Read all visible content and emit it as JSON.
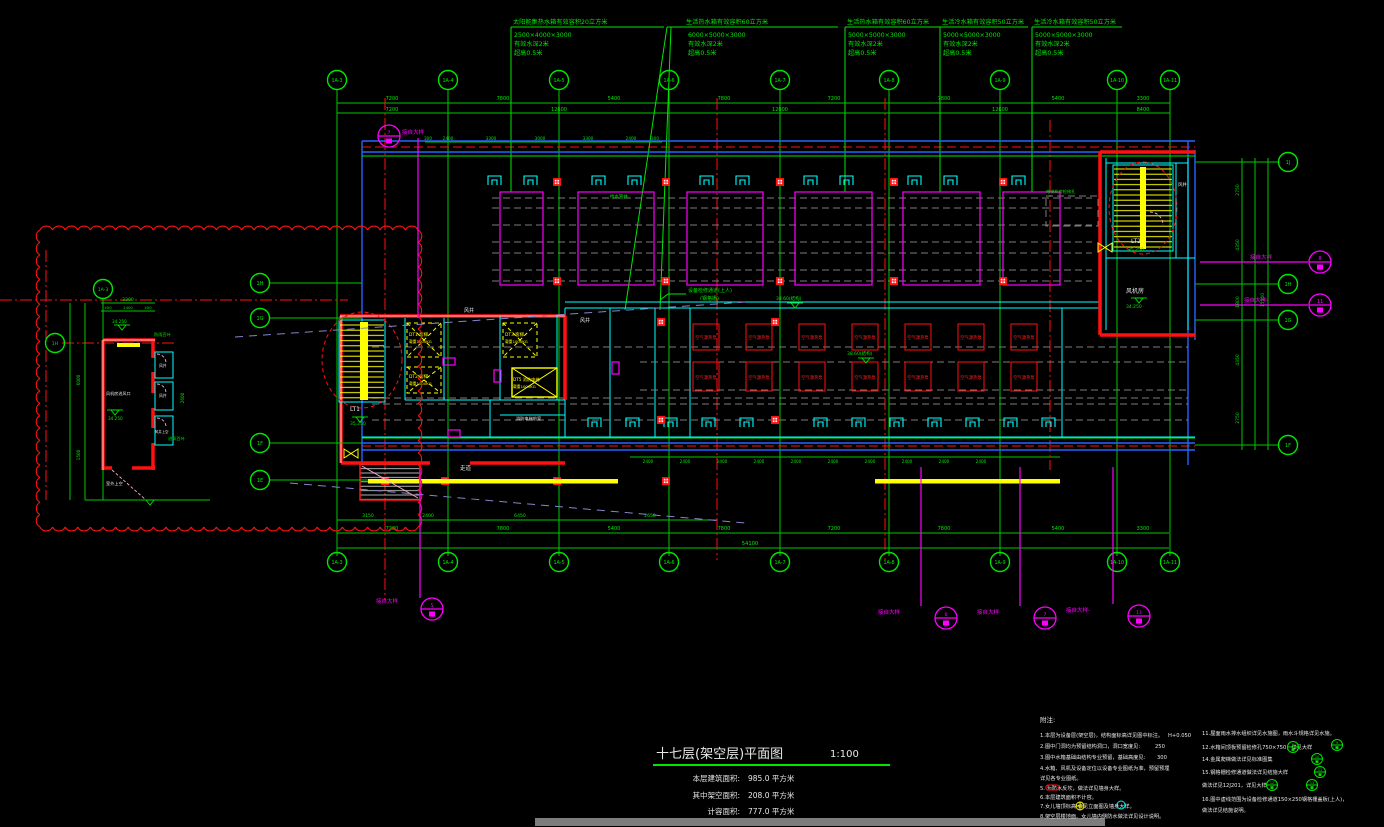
{
  "palette": {
    "bg": "#000000",
    "green": "#00e600",
    "red": "#ff1111",
    "magenta": "#ff00ff",
    "cyan": "#00ffff",
    "yellow": "#ffff00",
    "blue": "#2565ff",
    "gray": "#8c8c8c",
    "white": "#e8e8e8",
    "lavender": "#8484cf"
  },
  "tank_notes": [
    {
      "l1": "太阳能集热水箱有效容积20立方米",
      "l2": "2500×4000×3000",
      "l3": "有效水深2米",
      "l4": "超高0.5米"
    },
    {
      "l1": "生活热水箱有效容积60立方米",
      "l2": "6000×5000×3000",
      "l3": "有效水深2米",
      "l4": "超高0.5米"
    },
    {
      "l1": "生活热水箱有效容积60立方米",
      "l2": "5000×5000×3000",
      "l3": "有效水深2米",
      "l4": "超高0.5米"
    },
    {
      "l1": "生活冷水箱有效容积50立方米",
      "l2": "5000×5000×3000",
      "l3": "有效水深2米",
      "l4": "超高0.5米"
    },
    {
      "l1": "生活冷水箱有效容积50立方米",
      "l2": "5000×5000×3000",
      "l3": "有效水深2米",
      "l4": "超高0.5米"
    }
  ],
  "grid": {
    "top": [
      "1A-3",
      "1A-4",
      "1A-5",
      "1A-6",
      "1A-7",
      "1A-8",
      "1A-9",
      "1A-10",
      "1A-11"
    ],
    "bottom": [
      "1A-3",
      "1A-4",
      "1A-5",
      "1A-6",
      "1A-7",
      "1A-8",
      "1A-9",
      "1A-10",
      "1A-11"
    ],
    "right": [
      "1J",
      "1H",
      "1G",
      "1F"
    ],
    "left": [
      "1H",
      "1G",
      "1F",
      "1E"
    ],
    "detail_top": "1A-3",
    "detail_left": "1H"
  },
  "dims": {
    "top_row1": [
      "7200",
      "7800",
      "5400",
      "7800",
      "7200",
      "7800",
      "5400",
      "3300"
    ],
    "top_row2": [
      "7200",
      "12600",
      "12000",
      "12600",
      "8400"
    ],
    "top_fine": [
      "300",
      "2400",
      "3300",
      "3000",
      "3300",
      "2400",
      "300"
    ],
    "bottom_fine_label": "2400",
    "bottom_row1": [
      "3150",
      "2400",
      "6450",
      "2650"
    ],
    "bottom_row2": [
      "7200",
      "7800",
      "5400",
      "7800",
      "7200",
      "7800",
      "5400",
      "3300"
    ],
    "bottom_overall": "54100",
    "right_chain": [
      "2750",
      "4350",
      "1800",
      "4350",
      "2750"
    ],
    "right_overall": "15500",
    "detail_overall": "3300",
    "detail_subs": [
      "450",
      "2400",
      "450"
    ],
    "detail_left_chain": [
      "6000",
      "1500"
    ],
    "detail_right": "2600"
  },
  "plan": {
    "heat_pump_label": "空气源热泵",
    "corridor": "走道",
    "shaft": "风井",
    "shaft_void": "风井上空",
    "fan_room": "风机房",
    "stair1": "LT1",
    "stair2": "LT2",
    "elev": [
      {
        "id": "DT1 客梯",
        "load": "载重1000KG"
      },
      {
        "id": "DT2 客梯",
        "load": "载重1000KG"
      },
      {
        "id": "DT3 客梯",
        "load": "载重1000KG"
      },
      {
        "id": "DT5 消防电梯",
        "load": "载重1000KG"
      }
    ],
    "lobby": "消防电梯前室",
    "catwalk1": "设备检修通道(上人)",
    "catwalk2": "(钢格栅)",
    "lv_3860": "38.60(结构)",
    "lv_35250": "35.250",
    "lv_34250": "34.250",
    "water_shaft": "给水管井",
    "hatch_label": "电梯机房检修孔",
    "detail_room": "风机房进风口",
    "detail_outdoor": "室外上空",
    "detail_louver": "防雨百叶",
    "detail_louver2": "进风百叶"
  },
  "callouts": {
    "ref": "接自大样",
    "ref_dash": "接自大样-",
    "sheet": "图",
    "n_topleft": "7",
    "n_b1": "5",
    "n_b2": "6",
    "n_b3": "7",
    "n_b4": "11",
    "n_r1": "8",
    "n_r2": "11"
  },
  "title_block": {
    "title": "十七层(架空层)平面图",
    "scale": "1:100",
    "rows": [
      {
        "label": "本层建筑面积:",
        "value": "985.0 平方米"
      },
      {
        "label": "其中架空面积:",
        "value": "208.0 平方米"
      },
      {
        "label": "计容面积:",
        "value": "777.0 平方米"
      }
    ]
  },
  "notes": {
    "header": "附注:",
    "col1": [
      "1.本层为设备层(架空层)，结构面标高详见图中标注。",
      "2.图中门洞均为预留结构洞口，洞口宽度见:",
      "3.图中水箱基础由结构专业预留，基础高度见:",
      "4.水箱、风机及设备定位以设备专业图纸为准，预留预埋",
      "   详见各专业图纸。",
      "5.         为防水反坎，做法详见墙身大样。",
      "6.本层建筑面积不计容。",
      "7.女儿墙顶标高      详见立面图及墙身大样。",
      "8.架空层楼地面、女儿墙内侧防水做法详见设计说明。"
    ],
    "col1_vals": [
      "H+0.050",
      "250",
      "300"
    ],
    "col2": [
      "11.屋面雨水排水组织详见水施图，雨水斗规格详见水施。",
      "12.水箱间顶板预留检修孔750×750，详见大样",
      "14.金属爬梯做法详见标准图集",
      "15.钢格栅检修通道做法详见结施大样",
      "     做法详见12J201，详见大样",
      "16.图中虚线范围为设备检修通道150×250钢格栅盖板(上人)，",
      "     做法详见结施说明。"
    ],
    "bubble_nums": [
      "8",
      "9",
      "10",
      "11",
      "12",
      "13"
    ]
  }
}
